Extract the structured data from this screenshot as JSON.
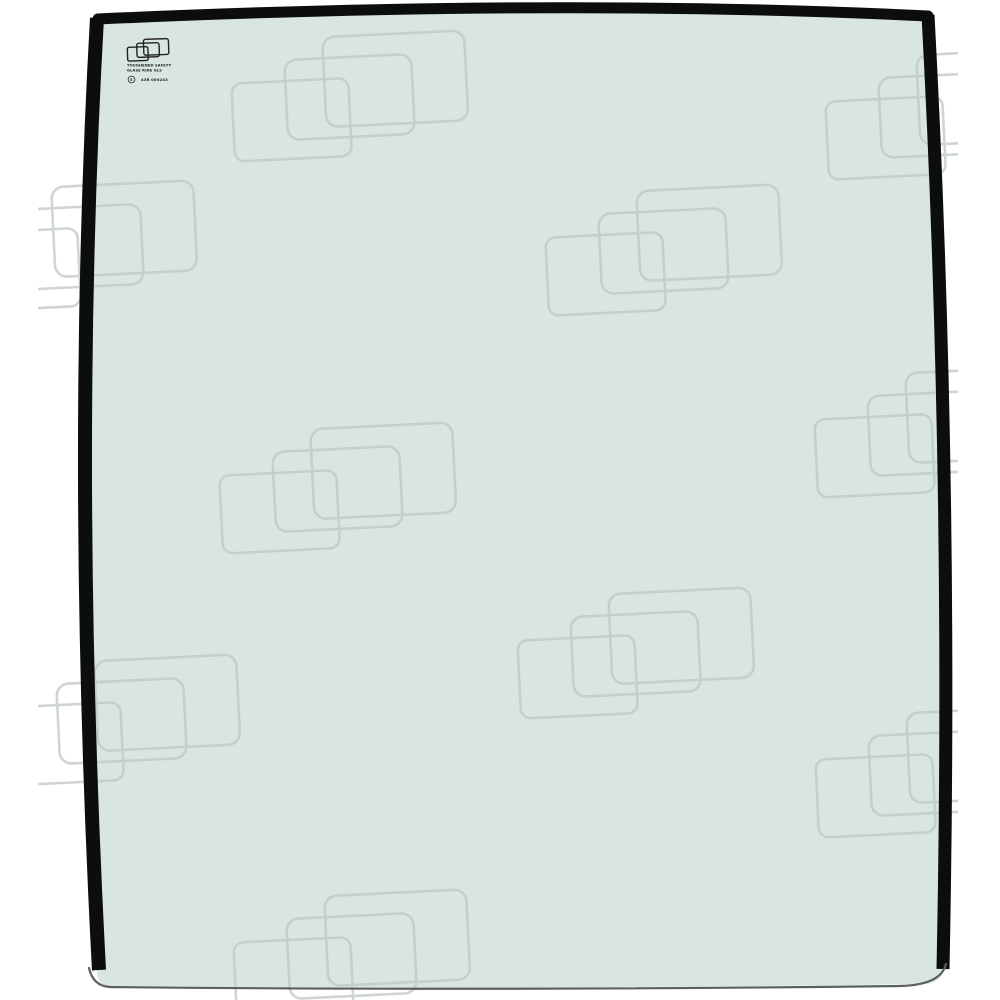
{
  "image": {
    "description": "Product photo of a curved tinted toughened-glass cab pane with black trim strips on the top, left and right edges, repeating overlapping-rectangle watermark over the whole photo, and a small manufacturer safety stamp in the upper-left corner of the glass"
  },
  "colors": {
    "background": "#ffffff",
    "glass_tint": "#d9e6e0",
    "trim_black": "#0c0d0d",
    "watermark_line": "#bec8c5",
    "bottom_edge": "#5a605e",
    "outer_bevel": "#cfd4d2",
    "stamp_ink": "#222222"
  },
  "stamp": {
    "icon": "overlapping-rectangles-logo",
    "line1": "TOUGHENED SAFETY",
    "line2": "GLASS RIDE GLS",
    "emark_label": "E",
    "line3": "43R 000243"
  },
  "watermark": {
    "icon": "overlapping-rectangles-watermark",
    "motif_rects": [
      {
        "x": 0,
        "y": 42,
        "w": 117,
        "h": 78,
        "rx": 10
      },
      {
        "x": 54,
        "y": 21,
        "w": 127,
        "h": 80,
        "rx": 12
      },
      {
        "x": 93,
        "y": 0,
        "w": 142,
        "h": 90,
        "rx": 12
      }
    ],
    "rotation_deg": -2.8,
    "stroke_width": 2.6,
    "opacity": 0.75,
    "clusters": [
      [
        232,
        36
      ],
      [
        826,
        54
      ],
      [
        -39,
        186
      ],
      [
        546,
        190
      ],
      [
        815,
        372
      ],
      [
        220,
        428
      ],
      [
        518,
        593
      ],
      [
        4,
        660
      ],
      [
        816,
        712
      ],
      [
        234,
        895
      ]
    ]
  }
}
